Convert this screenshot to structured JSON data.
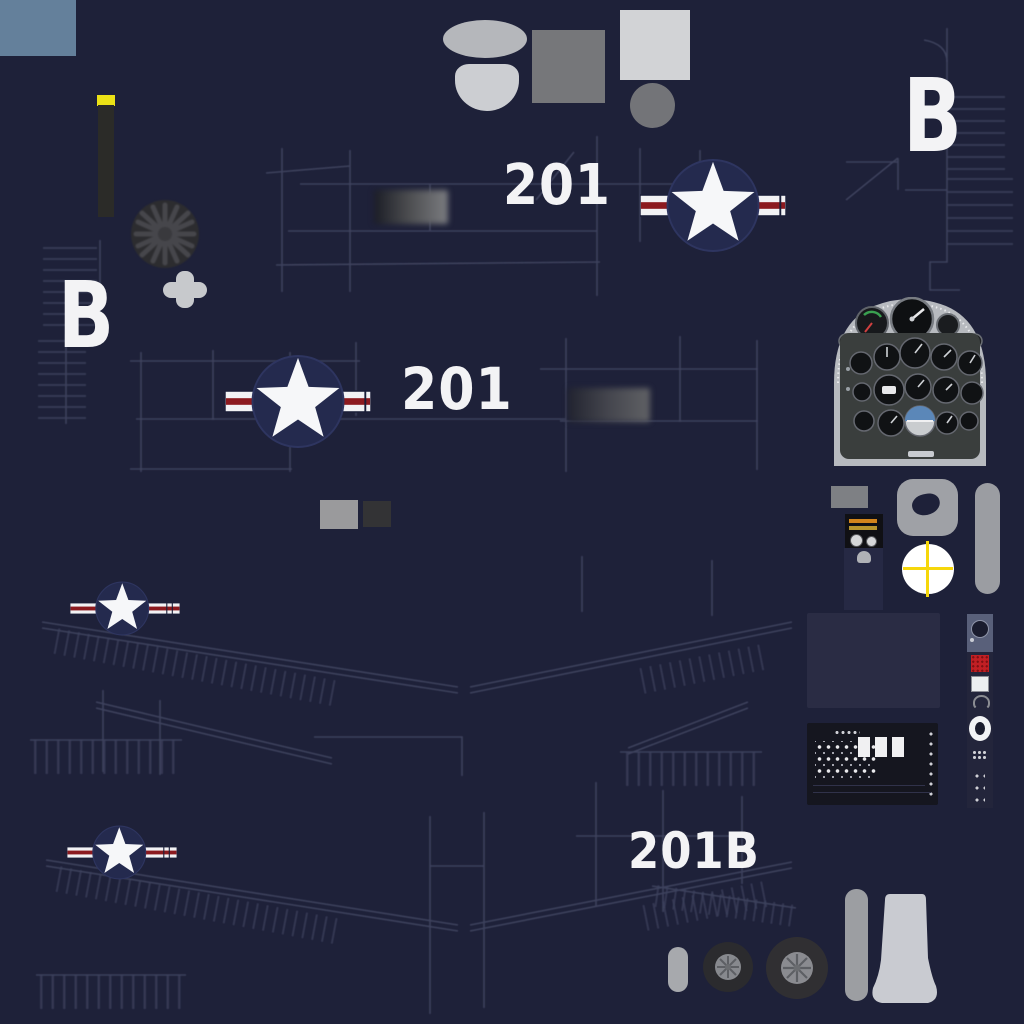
{
  "texture": {
    "description": "aircraft livery texture atlas sheet",
    "background_color": "#1e2139",
    "markings": {
      "tail_letter_left": "B",
      "tail_letter_right": "B",
      "nose_number_top": "201",
      "nose_number_mid": "201",
      "flap_number": "201B"
    },
    "colors": {
      "marking_white": "#f3f3f5",
      "insignia_red": "#8c1a1f",
      "insignia_field_blue": "#242a4e",
      "panel_line": "#424662",
      "canopy_glass_gray_blue": "#64809b",
      "warning_yellow": "#ece216",
      "life_raft_yellow": "#f6d70a",
      "metal_gray_light": "#c9cbd1",
      "metal_gray_mid": "#76777a",
      "tire_black": "#2b2b2e"
    },
    "parts": [
      "canopy-glass-swatch",
      "antenna-mast-stripe",
      "propeller-disc",
      "first-aid-cross",
      "national-insignia-roundel",
      "cockpit-instrument-panel",
      "throttle-quadrant",
      "headrest-donut-pad",
      "boarding-step-bar",
      "life-raft-marker",
      "avionics-bay-panel",
      "switch-console",
      "side-console-strip",
      "tail-wheel",
      "main-wheel",
      "landing-gear-strut",
      "gear-leg-fairing",
      "exhaust-stain-patch",
      "sensor-window-squares",
      "wing-panel-linework",
      "misc-gray-fairing-shapes"
    ]
  }
}
